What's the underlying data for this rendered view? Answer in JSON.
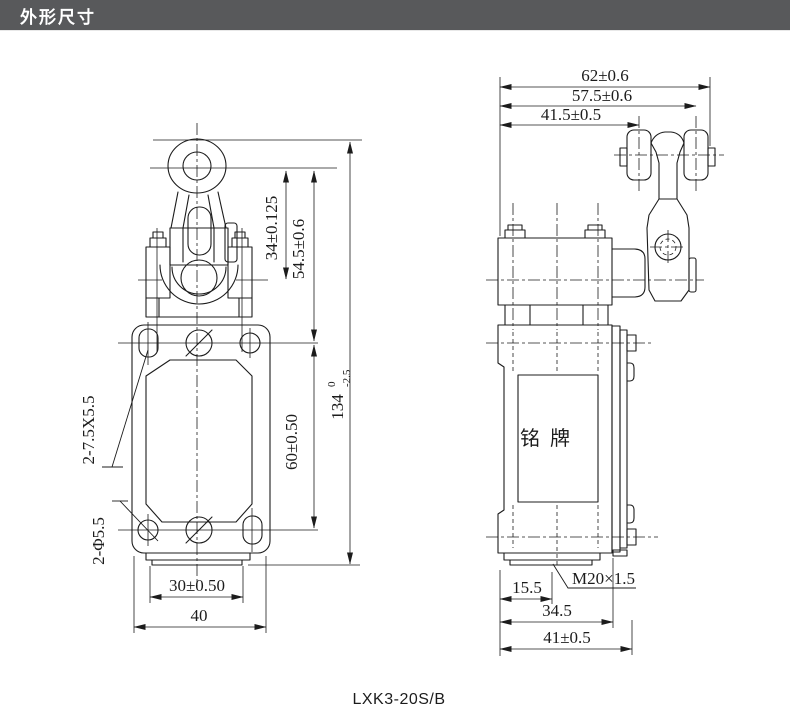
{
  "header": {
    "title": "外形尺寸"
  },
  "model_label": "LXK3-20S/B",
  "front_view": {
    "dims": {
      "lever_travel": "34±0.125",
      "lever_height": "54.5±0.6",
      "mount_spacing": "60±0.50",
      "total_height_main": "134",
      "total_height_tol_upper": "0",
      "total_height_tol_lower": "-2.5",
      "mount_width": "30±0.50",
      "body_width": "40",
      "slot_note": "2-7.5X5.5",
      "hole_note": "2-Φ5.5"
    }
  },
  "side_view": {
    "dims": {
      "overall_width": "62±0.6",
      "roller_center": "57.5±0.6",
      "lever_center": "41.5±0.5",
      "conduit_offset": "15.5",
      "thread_spec": "M20×1.5",
      "base_depth": "34.5",
      "overall_depth": "41±0.5"
    },
    "nameplate": "铭牌"
  },
  "colors": {
    "header_bg": "#58595b",
    "header_fg": "#ffffff",
    "line": "#1c1c1c",
    "bg": "#ffffff"
  }
}
